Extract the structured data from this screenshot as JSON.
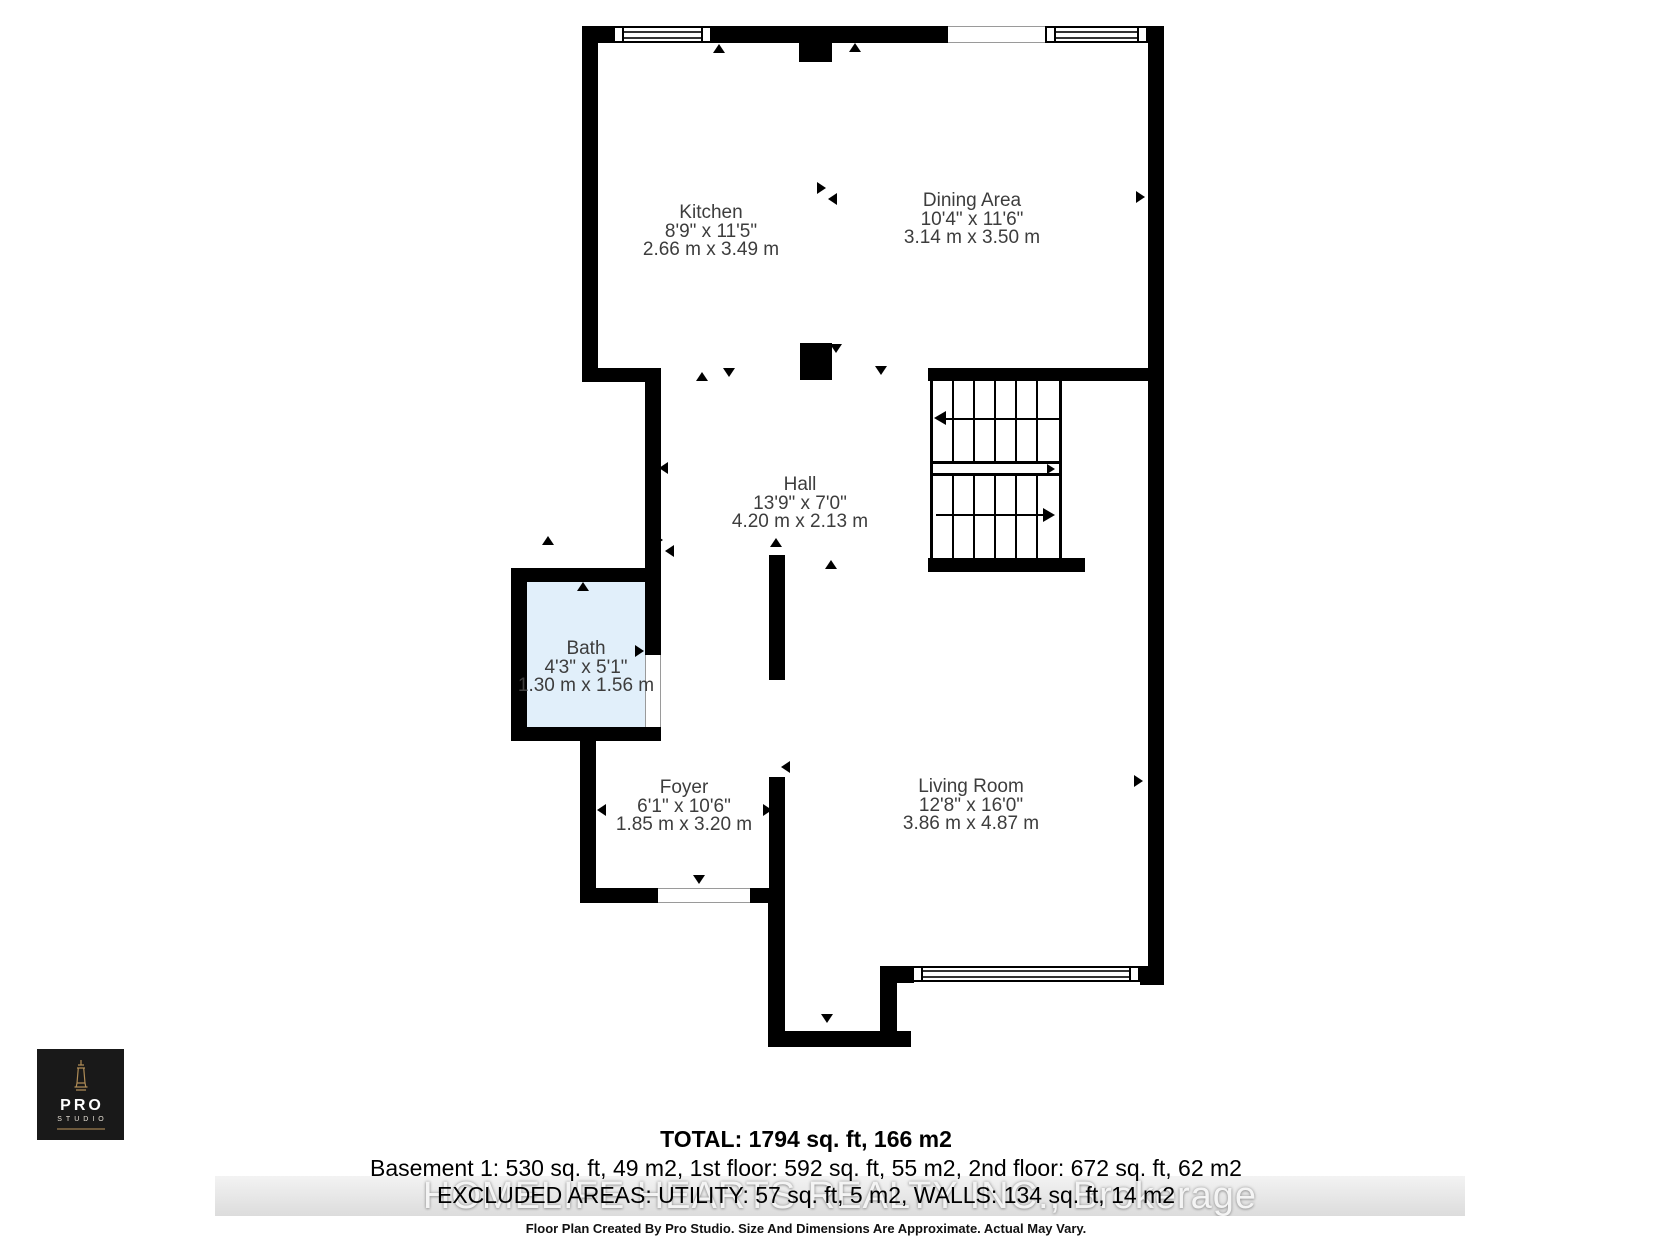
{
  "colors": {
    "wall": "#000000",
    "bath_fill": "#e1effa",
    "marker": "#000000",
    "watermark_text": "#f4f4f4",
    "logo_bg": "#191919",
    "logo_gold": "#b08d57"
  },
  "rooms": {
    "kitchen": {
      "name": "Kitchen",
      "imperial": "8'9\" x 11'5\"",
      "metric": "2.66 m x 3.49 m"
    },
    "dining": {
      "name": "Dining Area",
      "imperial": "10'4\" x 11'6\"",
      "metric": "3.14 m x 3.50 m"
    },
    "hall": {
      "name": "Hall",
      "imperial": "13'9\" x 7'0\"",
      "metric": "4.20 m x 2.13 m"
    },
    "bath": {
      "name": "Bath",
      "imperial": "4'3\" x 5'1\"",
      "metric": "1.30 m x 1.56 m"
    },
    "foyer": {
      "name": "Foyer",
      "imperial": "6'1\" x 10'6\"",
      "metric": "1.85 m x 3.20 m"
    },
    "living": {
      "name": "Living Room",
      "imperial": "12'8\" x 16'0\"",
      "metric": "3.86 m x 4.87 m"
    }
  },
  "footer": {
    "total": "TOTAL: 1794 sq. ft, 166 m2",
    "breakdown": "Basement 1: 530 sq. ft, 49 m2, 1st floor: 592 sq. ft, 55 m2, 2nd floor: 672 sq. ft, 62 m2",
    "excluded": "EXCLUDED AREAS: UTILITY: 57 sq. ft, 5 m2, WALLS: 134 sq. ft, 14 m2",
    "disclaimer": "Floor Plan Created By Pro Studio. Size And Dimensions Are Approximate. Actual May Vary."
  },
  "watermark": {
    "text": "HOMELIFE HEARTS REALTY INC., Brokerage"
  },
  "logo": {
    "line1": "PRO",
    "line2": "STUDIO"
  }
}
